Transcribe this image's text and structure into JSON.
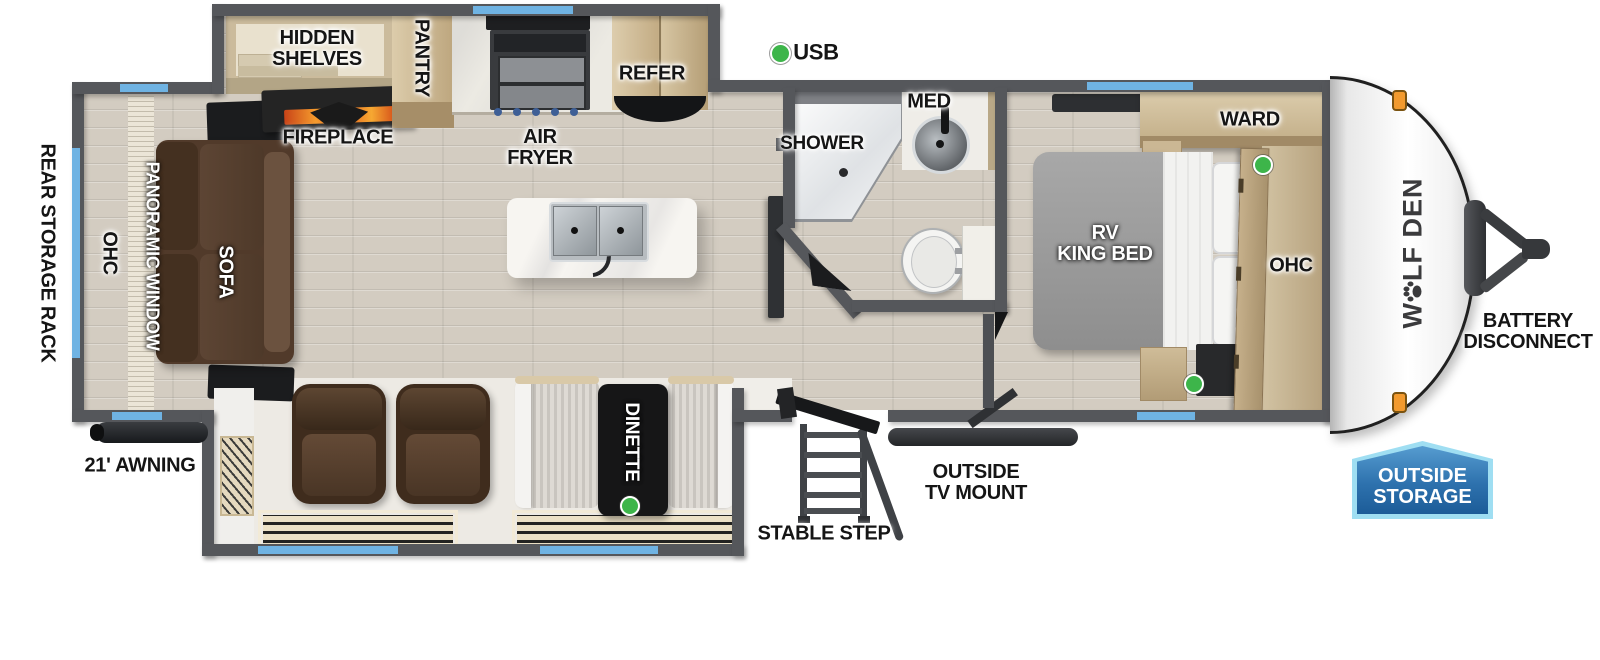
{
  "legend": {
    "usb_label": "USB"
  },
  "exterior": {
    "brand_pre": "W",
    "brand_post": "LF DEN",
    "battery_line1": "BATTERY",
    "battery_line2": "DISCONNECT",
    "outside_storage_line1": "OUTSIDE",
    "outside_storage_line2": "STORAGE",
    "awning_label": "21' AWNING",
    "rear_storage_rack_label": "REAR STORAGE RACK",
    "stable_step_label": "STABLE STEP",
    "tv_mount_line1": "OUTSIDE",
    "tv_mount_line2": "TV MOUNT"
  },
  "living": {
    "ohc_label": "OHC",
    "panoramic_window_label": "PANORAMIC WINDOW",
    "sofa_label": "SOFA",
    "hidden_shelves_line1": "HIDDEN",
    "hidden_shelves_line2": "SHELVES",
    "fireplace_label": "FIREPLACE",
    "pantry_label": "PANTRY",
    "air_fryer_line1": "AIR",
    "air_fryer_line2": "FRYER",
    "refer_label": "REFER",
    "dinette_label": "DINETTE"
  },
  "bath": {
    "shower_label": "SHOWER",
    "med_label": "MED"
  },
  "bedroom": {
    "ward_label": "WARD",
    "bed_line1": "RV",
    "bed_line2": "KING BED",
    "ohc_label": "OHC"
  },
  "colors": {
    "window_blue": "#6fb3e3",
    "wall_gray": "#55575b",
    "usb_green": "#3db54a",
    "badge_border": "#9fdef2",
    "badge_blue_top": "#569cd0",
    "badge_blue_bottom": "#1c5c98",
    "flame_orange": "#f2691f",
    "sofa_brown": "#513a2a",
    "wood_tan": "#d0c0a0"
  }
}
